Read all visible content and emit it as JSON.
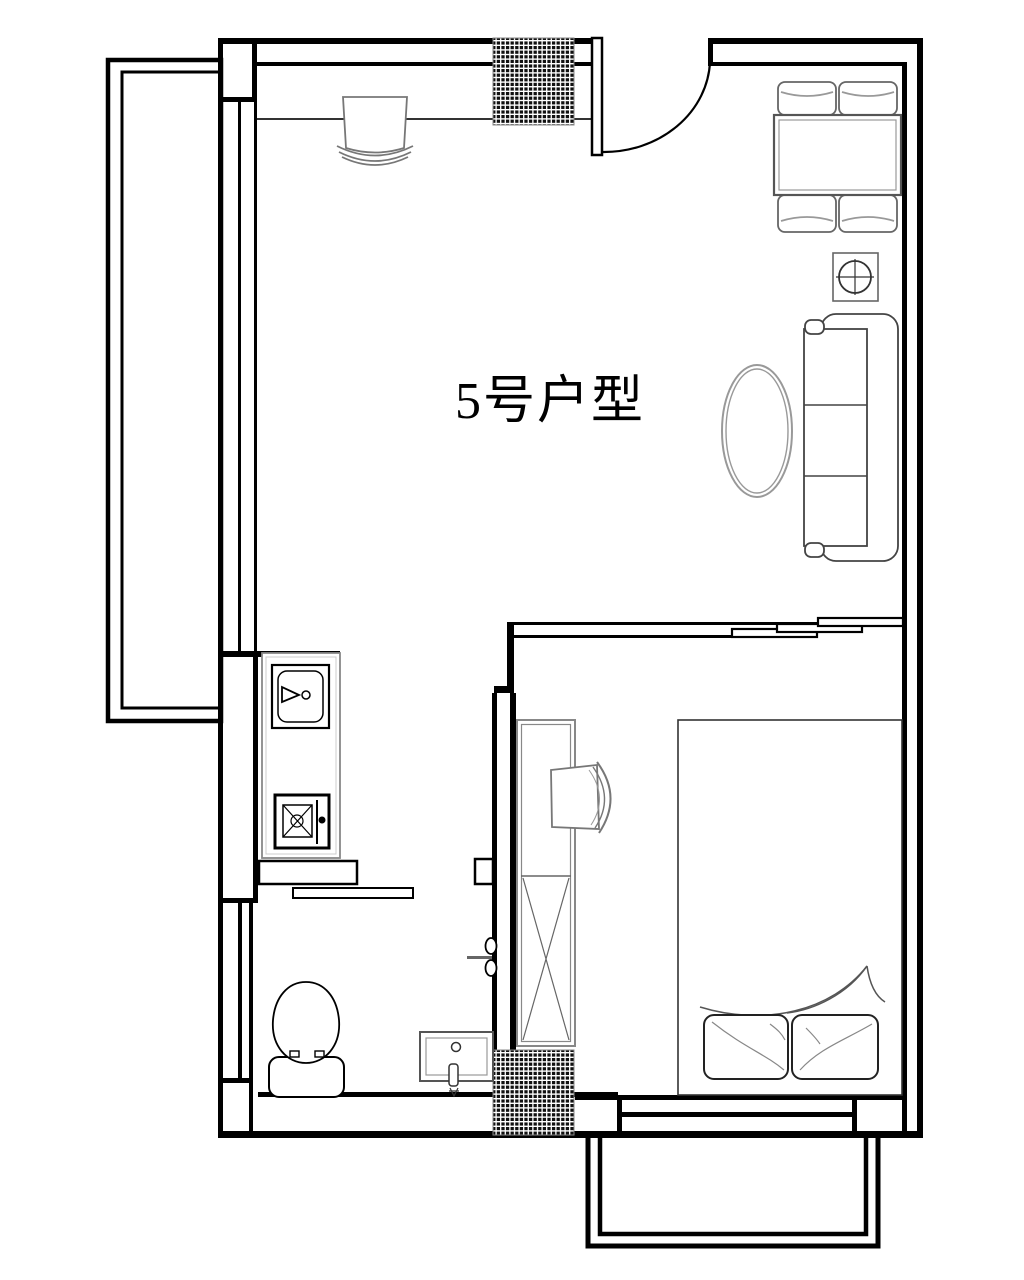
{
  "plan": {
    "title": "5号户型",
    "type_label": "floor-plan"
  },
  "colors": {
    "background": "#ffffff",
    "wall": "#000000",
    "column_hatch": "#111111",
    "furniture_line": "#555555",
    "light_line": "#999999"
  },
  "rooms": {
    "living": "living-dining-area",
    "bedroom": "bedroom",
    "bathroom": "bathroom",
    "kitchen": "kitchenette",
    "balcony_left": "side-balcony",
    "balcony_bottom": "bedroom-balcony"
  },
  "furniture": [
    "entry-door",
    "desk-chair-top",
    "dining-table",
    "dining-chairs",
    "side-stool",
    "sofa",
    "oval-coffee-table",
    "kitchen-sink",
    "kitchen-stove",
    "toilet",
    "washbasin",
    "pivot-door",
    "sliding-door-bedroom",
    "sliding-door-bathroom",
    "wardrobe",
    "bedroom-chair",
    "double-bed",
    "pillows"
  ]
}
